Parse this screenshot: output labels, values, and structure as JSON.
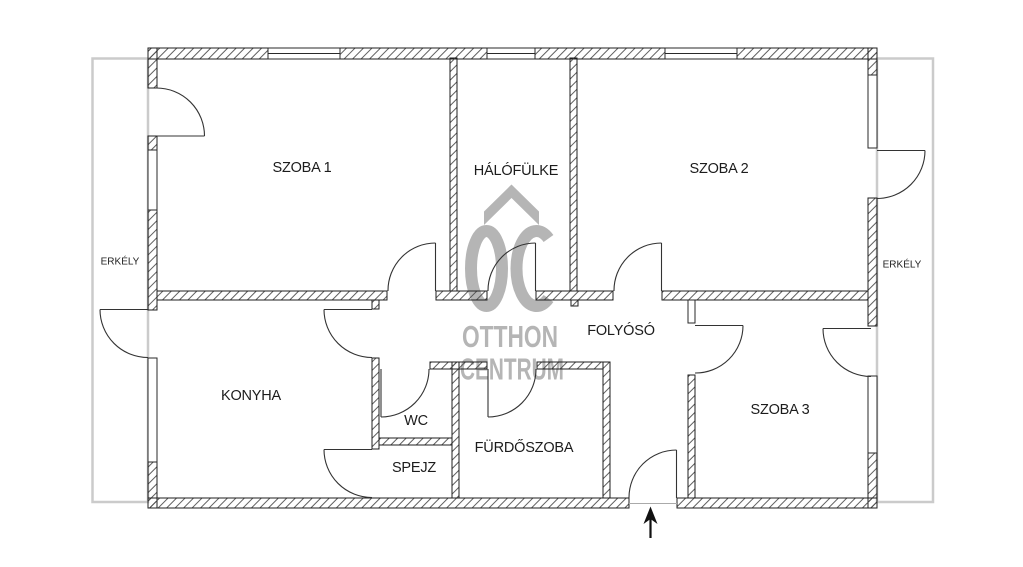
{
  "rooms": {
    "szoba1": {
      "label": "SZOBA 1"
    },
    "halofulke": {
      "label": "HÁLÓFÜLKE"
    },
    "szoba2": {
      "label": "SZOBA 2"
    },
    "folyoso": {
      "label": "FOLYÓSÓ"
    },
    "konyha": {
      "label": "KONYHA"
    },
    "wc": {
      "label": "WC"
    },
    "spejz": {
      "label": "SPEJZ"
    },
    "furdoszoba": {
      "label": "FÜRDŐSZOBA"
    },
    "szoba3": {
      "label": "SZOBA 3"
    },
    "erkely_left": {
      "label": "ERKÉLY"
    },
    "erkely_right": {
      "label": "ERKÉLY"
    }
  },
  "watermark": {
    "monogram": "OC",
    "line1": "OTTHON",
    "line2": "CENTRUM"
  },
  "colors": {
    "background": "#ffffff",
    "wall_line": "#1f1f1f",
    "hatch_line": "#4d4d4d",
    "door_line": "#333333",
    "balcony_outline": "#cbcbcb",
    "watermark": "#b5b5b5",
    "label_text": "#1c1c1c"
  }
}
